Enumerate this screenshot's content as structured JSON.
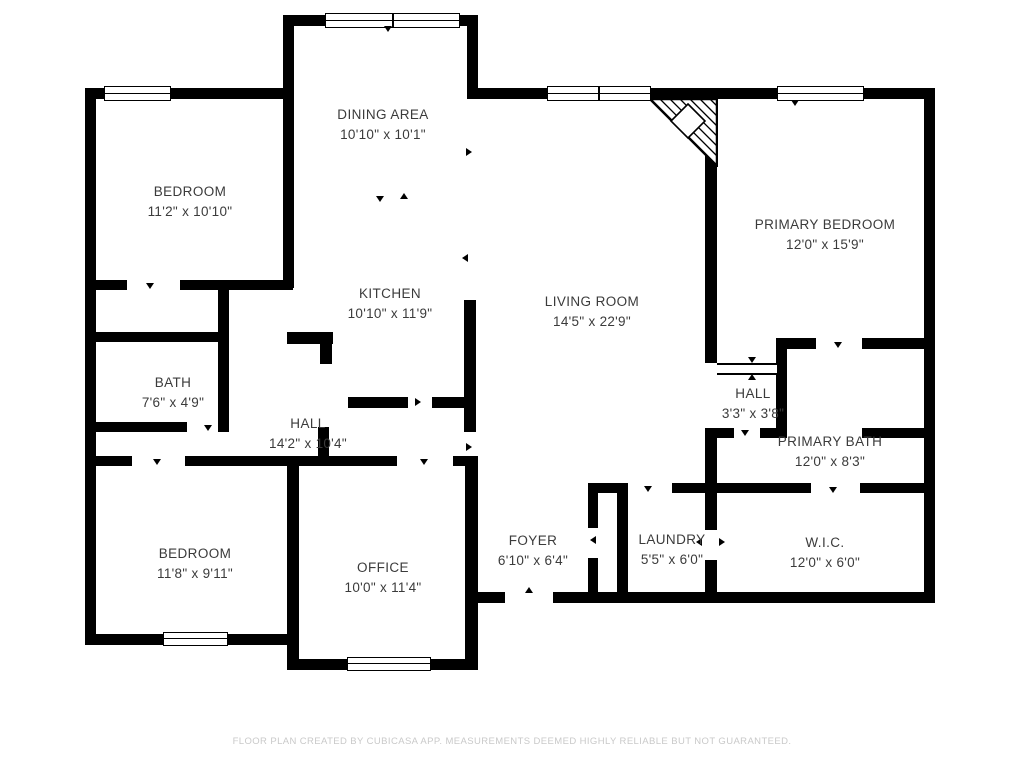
{
  "footer": {
    "text": "FLOOR PLAN CREATED BY CUBICASA APP. MEASUREMENTS DEEMED HIGHLY RELIABLE BUT NOT GUARANTEED."
  },
  "colors": {
    "wall": "#000000",
    "room_label": "#3b3b3b",
    "footer_text": "#c9c9c9",
    "background": "#ffffff"
  },
  "rooms": [
    {
      "name": "BEDROOM",
      "dims": "11'2\" x 10'10\""
    },
    {
      "name": "DINING AREA",
      "dims": "10'10\" x 10'1\""
    },
    {
      "name": "PRIMARY BEDROOM",
      "dims": "12'0\" x 15'9\""
    },
    {
      "name": "KITCHEN",
      "dims": "10'10\" x 11'9\""
    },
    {
      "name": "LIVING ROOM",
      "dims": "14'5\" x 22'9\""
    },
    {
      "name": "BATH",
      "dims": "7'6\" x 4'9\""
    },
    {
      "name": "HALL",
      "dims": "14'2\" x 10'4\""
    },
    {
      "name": "HALL",
      "dims": "3'3\" x 3'8\""
    },
    {
      "name": "PRIMARY BATH",
      "dims": "12'0\" x 8'3\""
    },
    {
      "name": "BEDROOM",
      "dims": "11'8\" x 9'11\""
    },
    {
      "name": "OFFICE",
      "dims": "10'0\" x 11'4\""
    },
    {
      "name": "FOYER",
      "dims": "6'10\" x 6'4\""
    },
    {
      "name": "LAUNDRY",
      "dims": "5'5\" x 6'0\""
    },
    {
      "name": "W.I.C.",
      "dims": "12'0\" x 6'0\""
    }
  ]
}
